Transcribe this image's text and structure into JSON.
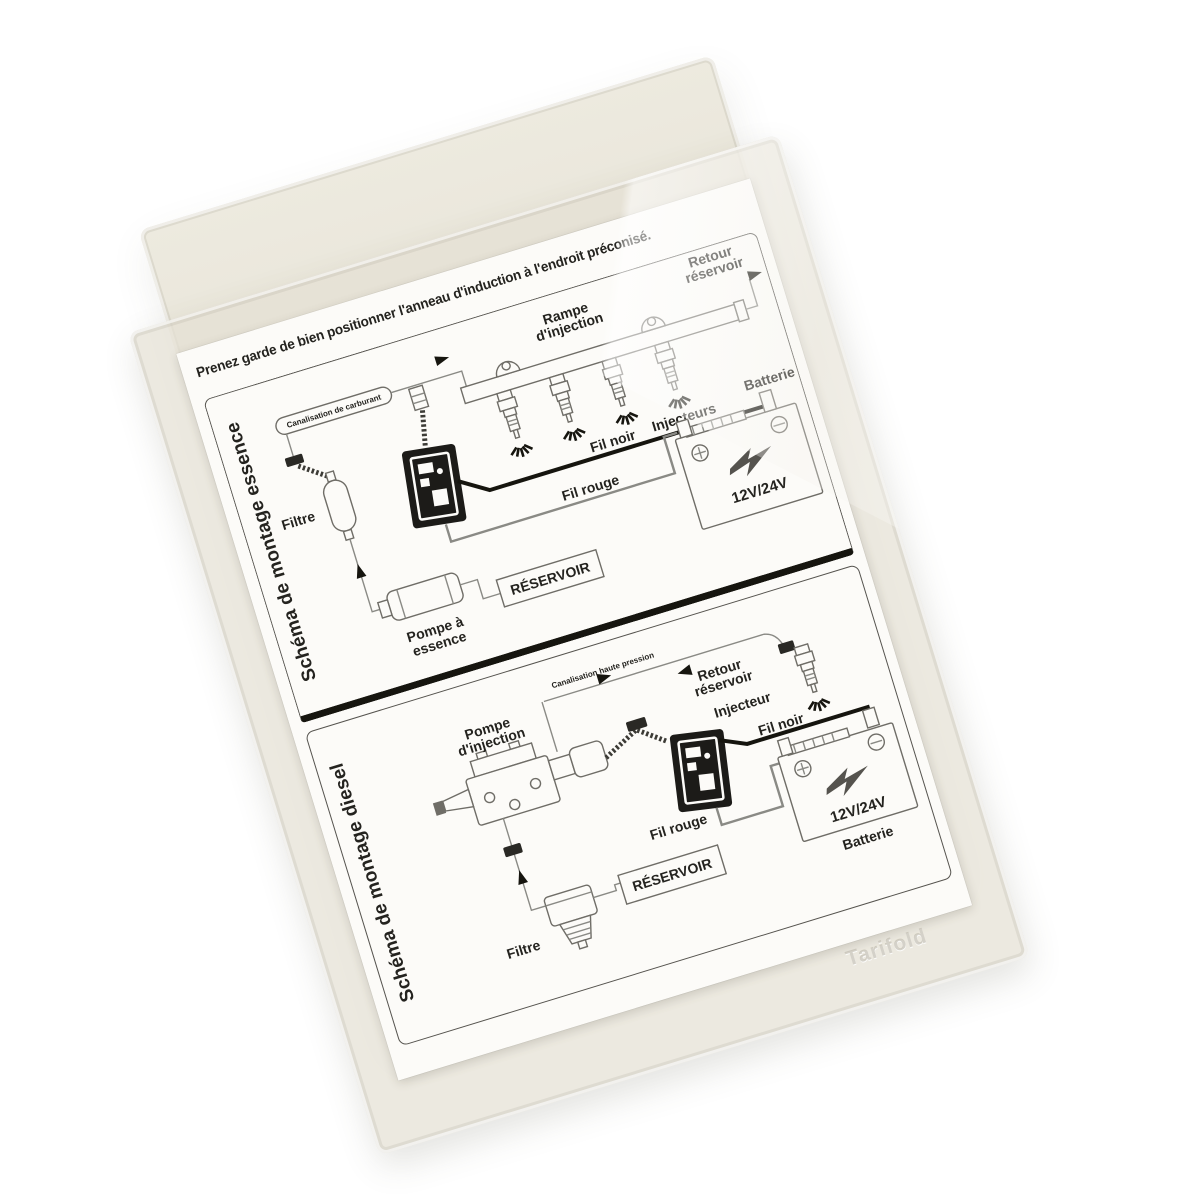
{
  "photo": {
    "background": "#ffffff"
  },
  "sleeve": {
    "watermark": "Tarifold",
    "color": "#e7e3d8"
  },
  "document": {
    "title": "Prenez garde de bien positionner l'anneau d'induction à l'endroit préconisé.",
    "ink_color": "#24231f",
    "sections": [
      {
        "id": "essence",
        "side_label": "Schéma de montage essence",
        "labels": {
          "canalisation": "Canalisation de carburant",
          "rampe": [
            "Rampe",
            "d'injection"
          ],
          "retour": [
            "Retour",
            "réservoir"
          ],
          "injecteurs": "Injecteurs",
          "filtre": "Filtre",
          "pompe": [
            "Pompe à",
            "essence"
          ],
          "reservoir": "RÉSERVOIR",
          "fil_noir": "Fil noir",
          "fil_rouge": "Fil rouge",
          "voltage": "12V/24V",
          "batterie": "Batterie"
        }
      },
      {
        "id": "diesel",
        "side_label": "Schéma de montage diesel",
        "labels": {
          "canalisation": "Canalisation haute pression",
          "pompe": [
            "Pompe",
            "d'injection"
          ],
          "retour": [
            "Retour",
            "réservoir"
          ],
          "injecteur": "Injecteur",
          "filtre": "Filtre",
          "reservoir": "RÉSERVOIR",
          "fil_noir": "Fil noir",
          "fil_rouge": "Fil rouge",
          "voltage": "12V/24V",
          "batterie": "Batterie"
        }
      }
    ]
  }
}
